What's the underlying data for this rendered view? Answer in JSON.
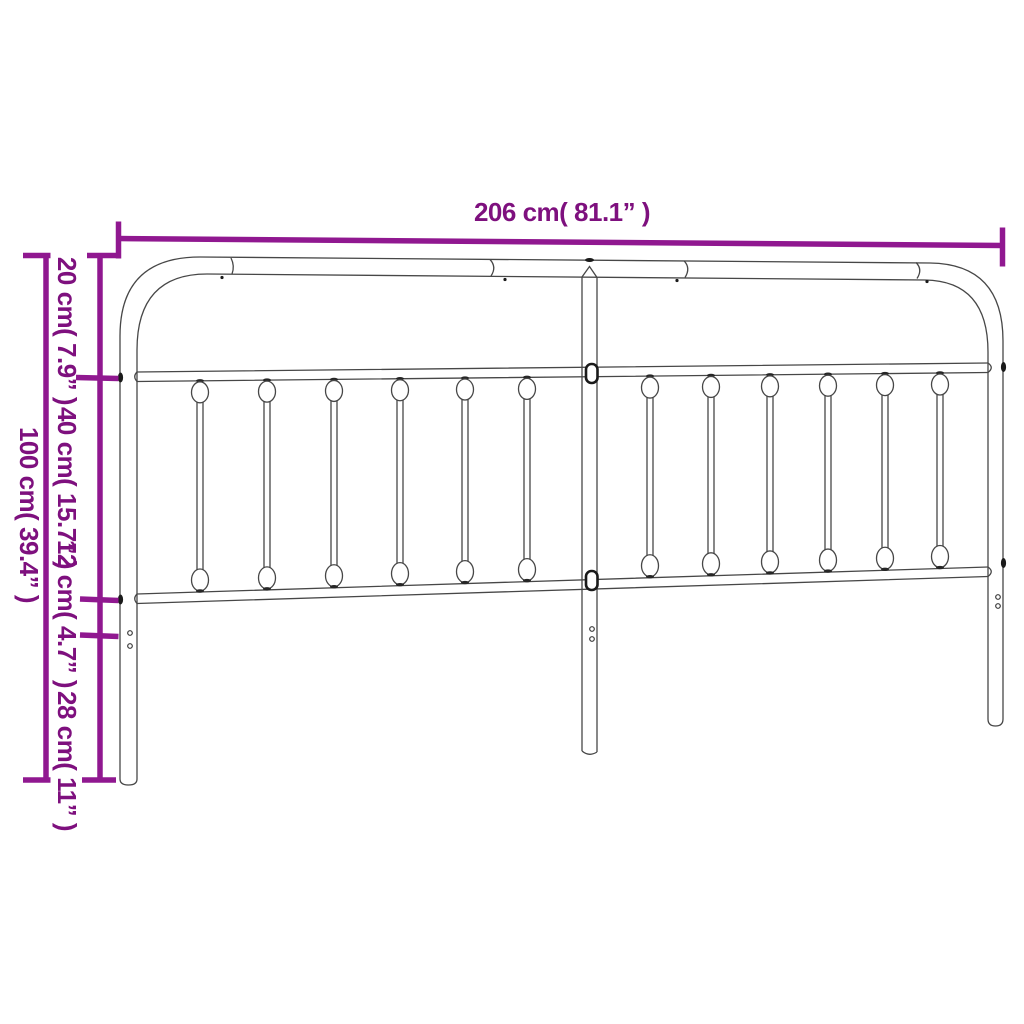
{
  "figure": {
    "type": "product-dimension-diagram",
    "subject": "metal headboard line drawing with twelve balusters"
  },
  "colors": {
    "background": "#ffffff",
    "dimension_line": "#901890",
    "dimension_text": "#7e107e",
    "drawing_line": "#474747"
  },
  "dimensions": {
    "width": {
      "label": "206 cm( 81.1” )",
      "cm": 206,
      "inch": 81.1
    },
    "total_height": {
      "label": "100 cm( 39.4” )",
      "cm": 100,
      "inch": 39.4
    },
    "segments": [
      {
        "label": "20 cm( 7.9” )",
        "cm": 20,
        "inch": 7.9
      },
      {
        "label": "40 cm( 15.7” )",
        "cm": 40,
        "inch": 15.7
      },
      {
        "label": "12 cm( 4.7” )",
        "cm": 12,
        "inch": 4.7
      },
      {
        "label": "28 cm( 11” )",
        "cm": 28,
        "inch": 11
      }
    ]
  }
}
